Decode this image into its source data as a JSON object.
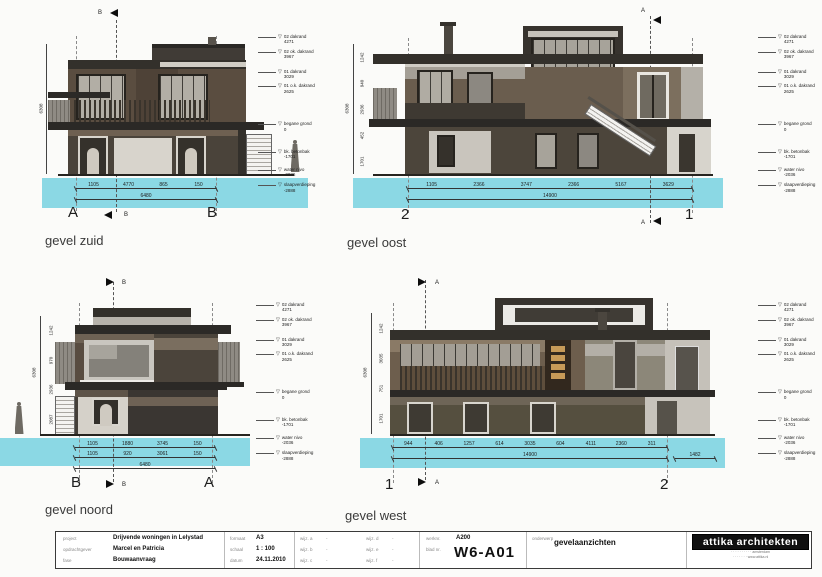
{
  "palette": {
    "water": "#8bd8e4",
    "roof_dark": "#33302b",
    "facade_brown": "#6a5d4e",
    "facade_grey": "#9b968d",
    "panel_light": "#d8d4cc",
    "frame_dark": "#26231e"
  },
  "levels": [
    {
      "label": "02 dakrand",
      "value": "4271"
    },
    {
      "label": "02 ok. dakrand",
      "value": "3967"
    },
    {
      "label": "01 dakrand",
      "value": "3029"
    },
    {
      "label": "01 o.k. dakrand",
      "value": "2625"
    },
    {
      "label": "begane grond",
      "value": "0"
    },
    {
      "label": "bk. betonbak",
      "value": "-1701"
    },
    {
      "label": "water nivo",
      "value": "-2036"
    },
    {
      "label": "slaapverdieping",
      "value": "-2888"
    }
  ],
  "elevations": {
    "zuid": {
      "title": "gevel zuid",
      "grid_left": "A",
      "grid_right": "B",
      "section_letter": "B",
      "dims": [
        "1105",
        "4770",
        "865",
        "150"
      ],
      "total": "6480",
      "overall_vdim": "6308"
    },
    "oost": {
      "title": "gevel oost",
      "grid_left": "2",
      "grid_right": "1",
      "section_letter": "A",
      "dims": [
        "1105",
        "2366",
        "3747",
        "2366",
        "5167",
        "3629"
      ],
      "total": "14900",
      "vdims": [
        "1242",
        "940",
        "2936",
        "452",
        "1701"
      ],
      "overall_vdim": "6308"
    },
    "noord": {
      "title": "gevel noord",
      "grid_left": "B",
      "grid_right": "A",
      "section_letter": "B",
      "dims": [
        "1105",
        "1880",
        "3745",
        "150"
      ],
      "dims2": [
        "1105",
        "920",
        "3061",
        "150"
      ],
      "total": "6480",
      "vdims": [
        "1242",
        "970",
        "2936",
        "2087"
      ],
      "overall_vdim": "6308"
    },
    "west": {
      "title": "gevel west",
      "grid_left": "1",
      "grid_right": "2",
      "section_letter": "A",
      "dims": [
        "944",
        "406",
        "1257",
        "614",
        "3035",
        "604",
        "4111",
        "2360",
        "311"
      ],
      "total": "14900",
      "extra": "1482",
      "vdims": [
        "1242",
        "3035",
        "751",
        "1701"
      ],
      "overall_vdim": "6308"
    }
  },
  "titleblock": {
    "labels": {
      "project": "project",
      "client": "opdrachtgever",
      "phase": "fase",
      "format": "formaat",
      "scale": "schaal",
      "date": "datum",
      "rev_a": "wijz. a",
      "rev_b": "wijz. b",
      "rev_c": "wijz. c",
      "rev_d": "wijz. d",
      "rev_e": "wijz. e",
      "rev_f": "wijz. f",
      "worknr": "werknr.",
      "sheet": "blad nr.",
      "subject": "onderwerp"
    },
    "values": {
      "project": "Drijvende woningen in Lelystad",
      "client": "Marcel en Patricia",
      "phase": "Bouwaanvraag",
      "format": "A3",
      "scale": "1 : 100",
      "date": "24.11.2010",
      "rev_a": "-",
      "rev_b": "-",
      "rev_c": "-",
      "rev_d": "-",
      "rev_e": "-",
      "rev_f": "-",
      "worknr": "A200",
      "sheet": "W6-A01",
      "subject": "gevelaanzichten"
    },
    "firm": {
      "name": "attika architekten",
      "address1": "· · · · · · · · · · amsterdam",
      "address2": "· · · · · · · www.attika.nl"
    }
  }
}
